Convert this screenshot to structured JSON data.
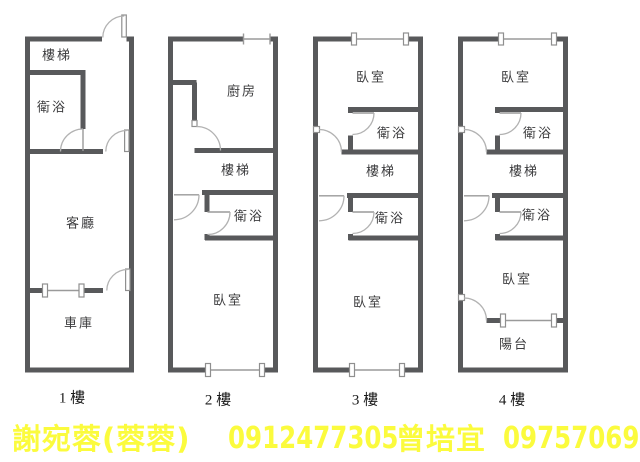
{
  "colors": {
    "wall": "#58595b",
    "window_line": "#9a9a9a",
    "room_label": "#3c3c3e",
    "floor_label": "#1a1a1a",
    "contact_text": "#fbfb3d",
    "background": "#ffffff"
  },
  "floors": [
    {
      "name": "1 樓",
      "rooms": [
        {
          "label": "樓梯"
        },
        {
          "label": "衛浴"
        },
        {
          "label": "客廳"
        },
        {
          "label": "車庫"
        }
      ]
    },
    {
      "name": "2 樓",
      "rooms": [
        {
          "label": "廚房"
        },
        {
          "label": "樓梯"
        },
        {
          "label": "衛浴"
        },
        {
          "label": "臥室"
        }
      ]
    },
    {
      "name": "3 樓",
      "rooms": [
        {
          "label": "臥室"
        },
        {
          "label": "衛浴"
        },
        {
          "label": "樓梯"
        },
        {
          "label": "衛浴"
        },
        {
          "label": "臥室"
        }
      ]
    },
    {
      "name": "4 樓",
      "rooms": [
        {
          "label": "臥室"
        },
        {
          "label": "衛浴"
        },
        {
          "label": "樓梯"
        },
        {
          "label": "衛浴"
        },
        {
          "label": "臥室"
        },
        {
          "label": "陽台"
        }
      ]
    }
  ],
  "contact": {
    "agent1_name": "謝宛蓉(蓉蓉)",
    "agent1_phone": "0912477305",
    "agent2_name": "曾培宜",
    "agent2_phone": "0975706937"
  }
}
